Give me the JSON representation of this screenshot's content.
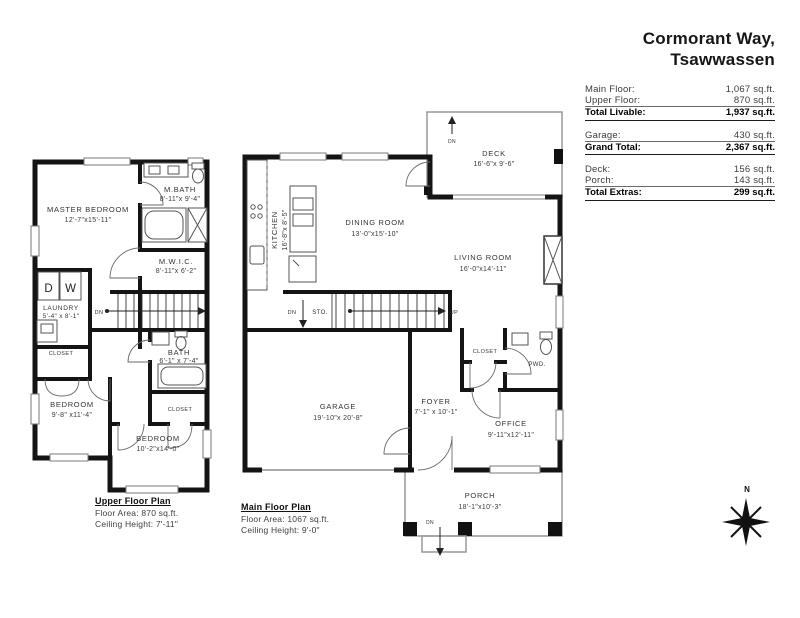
{
  "header": {
    "title_line1": "Cormorant Way,",
    "title_line2": "Tsawwassen"
  },
  "palette": {
    "wall": "#141414",
    "thin_gray": "#999999",
    "text_dark": "#1a1a1a"
  },
  "area_table": {
    "sections": [
      {
        "rows": [
          {
            "label": "Main Floor:",
            "value": "1,067 sq.ft."
          },
          {
            "label": "Upper Floor:",
            "value": "870 sq.ft."
          }
        ],
        "total": {
          "label": "Total Livable:",
          "value": "1,937 sq.ft."
        }
      },
      {
        "rows": [
          {
            "label": "Garage:",
            "value": "430 sq.ft."
          }
        ],
        "total": {
          "label": "Grand Total:",
          "value": "2,367 sq.ft."
        }
      },
      {
        "rows": [
          {
            "label": "Deck:",
            "value": "156 sq.ft."
          },
          {
            "label": "Porch:",
            "value": "143 sq.ft."
          }
        ],
        "total": {
          "label": "Total Extras:",
          "value": "299 sq.ft."
        }
      }
    ]
  },
  "upper": {
    "plan_title": "Upper Floor Plan",
    "floor_area": "Floor Area: 870 sq.ft.",
    "ceiling_height": "Ceiling Height: 7'-11\"",
    "rooms": {
      "master": {
        "name": "MASTER BEDROOM",
        "dims": "12'-7\"x15'-11\""
      },
      "mbath": {
        "name": "M.BATH",
        "dims": "8'-11\"x 9'-4\""
      },
      "mwic": {
        "name": "M.W.I.C.",
        "dims": "8'-11\"x 6'-2\""
      },
      "laundry": {
        "name": "LAUNDRY",
        "dims": "5'-4\" x 8'-1\""
      },
      "closet1": {
        "name": "CLOSET"
      },
      "bath": {
        "name": "BATH",
        "dims": "6'-1\" x 7'-4\""
      },
      "bedroom1": {
        "name": "BEDROOM",
        "dims": "9'-8\" x11'-4\""
      },
      "closet2": {
        "name": "CLOSET"
      },
      "bedroom2": {
        "name": "BEDROOM",
        "dims": "10'-2\"x14'-0\""
      }
    },
    "labels": {
      "dryer": "D",
      "washer": "W",
      "dn": "DN"
    }
  },
  "main": {
    "plan_title": "Main Floor Plan",
    "floor_area": "Floor Area: 1067 sq.ft.",
    "ceiling_height": "Ceiling Height: 9'-0\"",
    "rooms": {
      "deck": {
        "name": "DECK",
        "dims": "16'-6\"x 9'-6\""
      },
      "kitchen": {
        "name": "KITCHEN",
        "dims": "16'-8\"x 8'-5\""
      },
      "dining": {
        "name": "DINING ROOM",
        "dims": "13'-0\"x15'-10\""
      },
      "living": {
        "name": "LIVING ROOM",
        "dims": "16'-0\"x14'-11\""
      },
      "storage": {
        "name": "STO."
      },
      "garage": {
        "name": "GARAGE",
        "dims": "19'-10\"x 20'-8\""
      },
      "foyer": {
        "name": "FOYER",
        "dims": "7'-1\" x 10'-1\""
      },
      "closet": {
        "name": "CLOSET"
      },
      "powder": {
        "name": "PWD."
      },
      "office": {
        "name": "OFFICE",
        "dims": "9'-11\"x12'-11\""
      },
      "porch": {
        "name": "PORCH",
        "dims": "18'-1\"x10'-3\""
      }
    },
    "labels": {
      "up": "UP",
      "dn_stairs": "DN",
      "dn_deck": "DN",
      "dn_porch": "DN"
    }
  },
  "compass": {
    "north": "N"
  }
}
